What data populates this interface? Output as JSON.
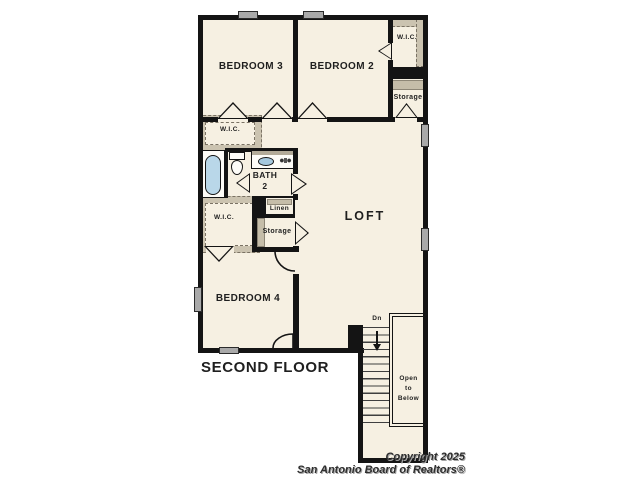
{
  "meta": {
    "type": "second-floor-plan"
  },
  "labels": {
    "bedroom3": "BEDROOM 3",
    "bedroom2": "BEDROOM 2",
    "bedroom4": "BEDROOM 4",
    "loft": "LOFT",
    "bath_line1": "BATH",
    "bath_line2": "2",
    "wic_top": "W.I.C.",
    "wic_mid": "W.I.C.",
    "wic_lower": "W.I.C.",
    "storage_top": "Storage",
    "storage_mid": "Storage",
    "linen": "Linen",
    "floor_title": "SECOND FLOOR",
    "stairs_down": "Dn",
    "open_below_line1": "Open",
    "open_below_line2": "to",
    "open_below_line3": "Below"
  },
  "footer": {
    "copyright_line1": "Copyright 2025",
    "copyright_line2": "San Antonio Board of Realtors®"
  },
  "colors": {
    "floor": "#f6f0e2",
    "wall": "#141414",
    "closet_hatch": "#cbc3b0",
    "window": "#a9a9a9",
    "tub_water": "#b9d7e9",
    "label_text": "#1f1f1f"
  }
}
